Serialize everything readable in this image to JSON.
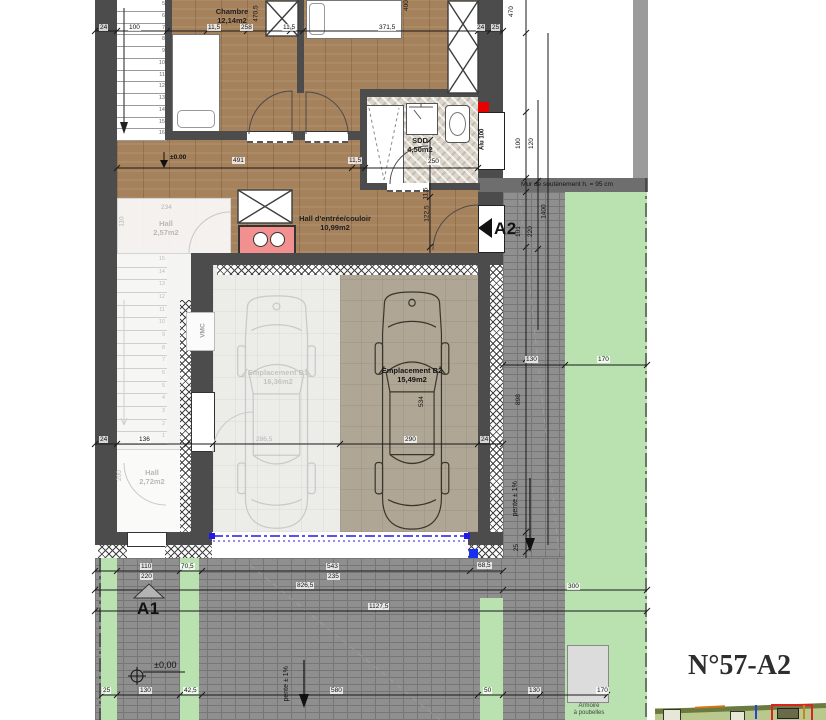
{
  "title": "N°57-A2",
  "rooms": {
    "chambre": {
      "name": "Chambre",
      "area": "12,14m2"
    },
    "sdd": {
      "name": "SDD",
      "area": "4,50m2"
    },
    "hall_entree": {
      "name": "Hall d'entrée/couloir",
      "area": "10,99m2"
    },
    "hall_57": {
      "name": "Hall",
      "area": "2,57m2"
    },
    "hall_72": {
      "name": "Hall",
      "area": "2,72m2"
    },
    "b1": {
      "name": "Emplacement B1",
      "area": "16,36m2"
    },
    "b2": {
      "name": "Emplacement B2",
      "area": "15,49m2"
    }
  },
  "markers": {
    "a1": "A1",
    "a2": "A2",
    "level_entry": "±0.00",
    "level_drive": "±0,00"
  },
  "annotations": {
    "retaining_wall": "Mur de soutènement h. = 95 cm",
    "slope_drive": "pente ± 1%",
    "slope_side": "pente ± 1%",
    "vmc": "VMC",
    "bins_line1": "Armoire",
    "bins_line2": "à poubelles",
    "window": "Alu 100"
  },
  "stairs": {
    "upper": [
      "5",
      "6",
      "7",
      "8",
      "9",
      "10",
      "11",
      "12",
      "13",
      "14",
      "15",
      "16"
    ],
    "lower": [
      "15",
      "14",
      "13",
      "12",
      "11",
      "10",
      "9",
      "8",
      "7",
      "6",
      "5",
      "4",
      "3",
      "2",
      "1"
    ]
  },
  "dims": {
    "t24": "24",
    "t100": "100",
    "t115a": "11,5",
    "t258": "258",
    "t115b": "11,5",
    "t3715": "371,5",
    "t24b": "24",
    "t25": "25",
    "v4705": "470,5",
    "v400": "400",
    "r470": "470",
    "r100": "100",
    "r120": "120",
    "r101": "101",
    "r220": "220",
    "r1400": "1400",
    "r130": "130",
    "r170": "170",
    "r898": "898",
    "r25": "25",
    "r300": "300",
    "h491": "491",
    "h115": "11,5",
    "h1225": "122,5",
    "h115v": "11,5",
    "h250": "250",
    "m24": "24",
    "m136": "136",
    "m2865": "286,5",
    "m290": "290",
    "m534": "534",
    "m24b": "24",
    "m234": "234",
    "m110": "110",
    "m200": "200",
    "d110": "110",
    "d705": "70,5",
    "d543": "543",
    "d685": "68,5",
    "d220": "220",
    "d235": "235",
    "d8265": "826,5",
    "d11275": "1127,5",
    "b25": "25",
    "b130": "130",
    "b425": "42,5",
    "b580": "580",
    "b50": "50",
    "b130b": "130",
    "b170": "170"
  }
}
